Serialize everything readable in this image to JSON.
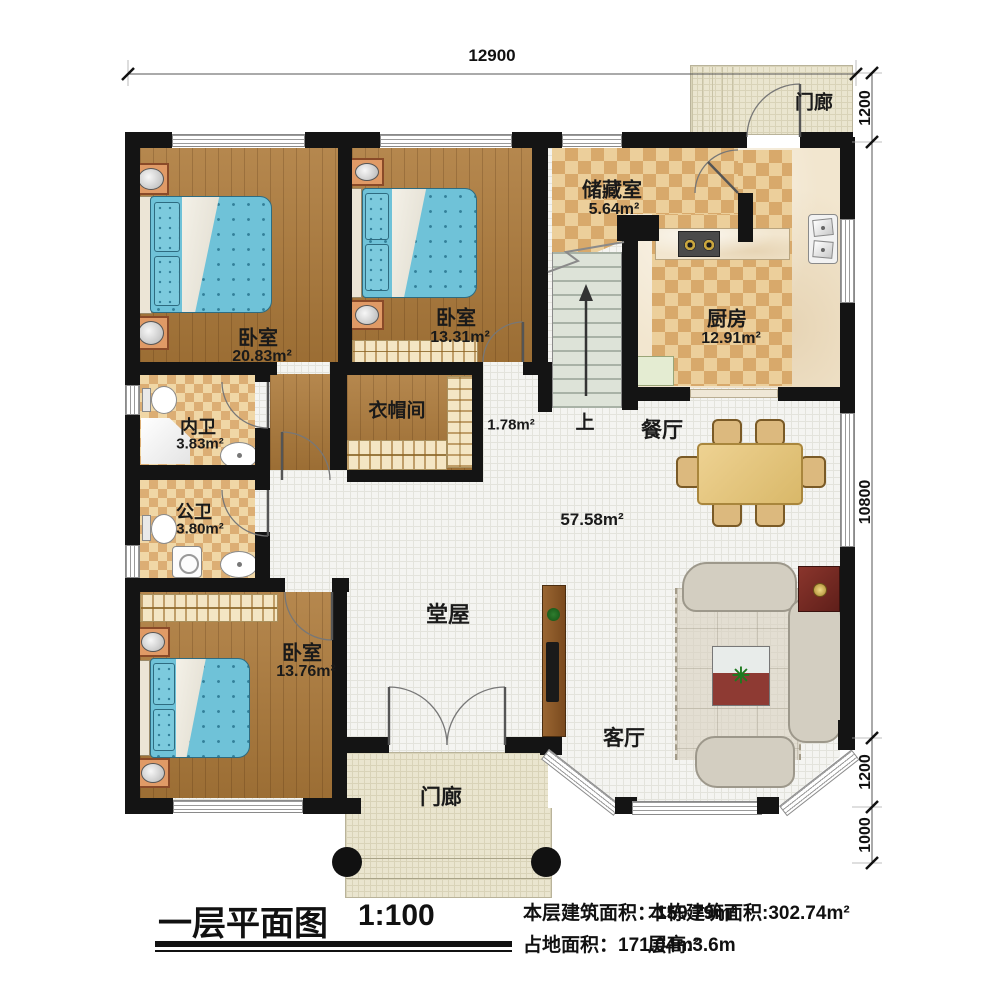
{
  "title_block": {
    "plan_title": "一层平面图",
    "scale": "1:100",
    "stats": {
      "floor_area_label": "本层建筑面积：",
      "floor_area_value": "159.79m²",
      "footprint_label": "占地面积：",
      "footprint_value": "171.04m²",
      "building_area_label": "本栋建筑面积:",
      "building_area_value": "302.74m²",
      "storey_height_label": "层高:",
      "storey_height_value": "3.6m"
    }
  },
  "dimensions": {
    "top_width": "12900",
    "right": [
      "1200",
      "10800",
      "1200",
      "1000"
    ]
  },
  "rooms": {
    "bedroom1": {
      "name": "卧室",
      "area": "20.83m²"
    },
    "bedroom2": {
      "name": "卧室",
      "area": "13.31m²"
    },
    "bedroom3": {
      "name": "卧室",
      "area": "13.76m²"
    },
    "storage": {
      "name": "储藏室",
      "area": "5.64m²"
    },
    "kitchen": {
      "name": "厨房",
      "area": "12.91m²"
    },
    "inner_bath": {
      "name": "内卫",
      "area": "3.83m²"
    },
    "public_bath": {
      "name": "公卫",
      "area": "3.80m²"
    },
    "cloakroom": {
      "name": "衣帽间"
    },
    "entry_nook": {
      "area": "1.78m²"
    },
    "hall": {
      "name": "堂屋",
      "area": "57.58m²"
    },
    "dining": {
      "name": "餐厅"
    },
    "living": {
      "name": "客厅"
    },
    "porch_top": {
      "name": "门廊"
    },
    "porch_bottom": {
      "name": "门廊"
    },
    "stairs": {
      "up_label": "上"
    }
  },
  "icons": {
    "plant_icon": "✳"
  },
  "colors": {
    "wall": "#141414",
    "wood_floor": "#ad7a3a",
    "tile_light": "#eccf9b",
    "tile_dark": "#d8a96b",
    "bed_blue": "#6fc2d8",
    "hall_floor": "#f4f4f1",
    "porch_floor": "#eae5cf",
    "stair_floor": "#dde3d8",
    "accent_red": "#8e3a33"
  }
}
